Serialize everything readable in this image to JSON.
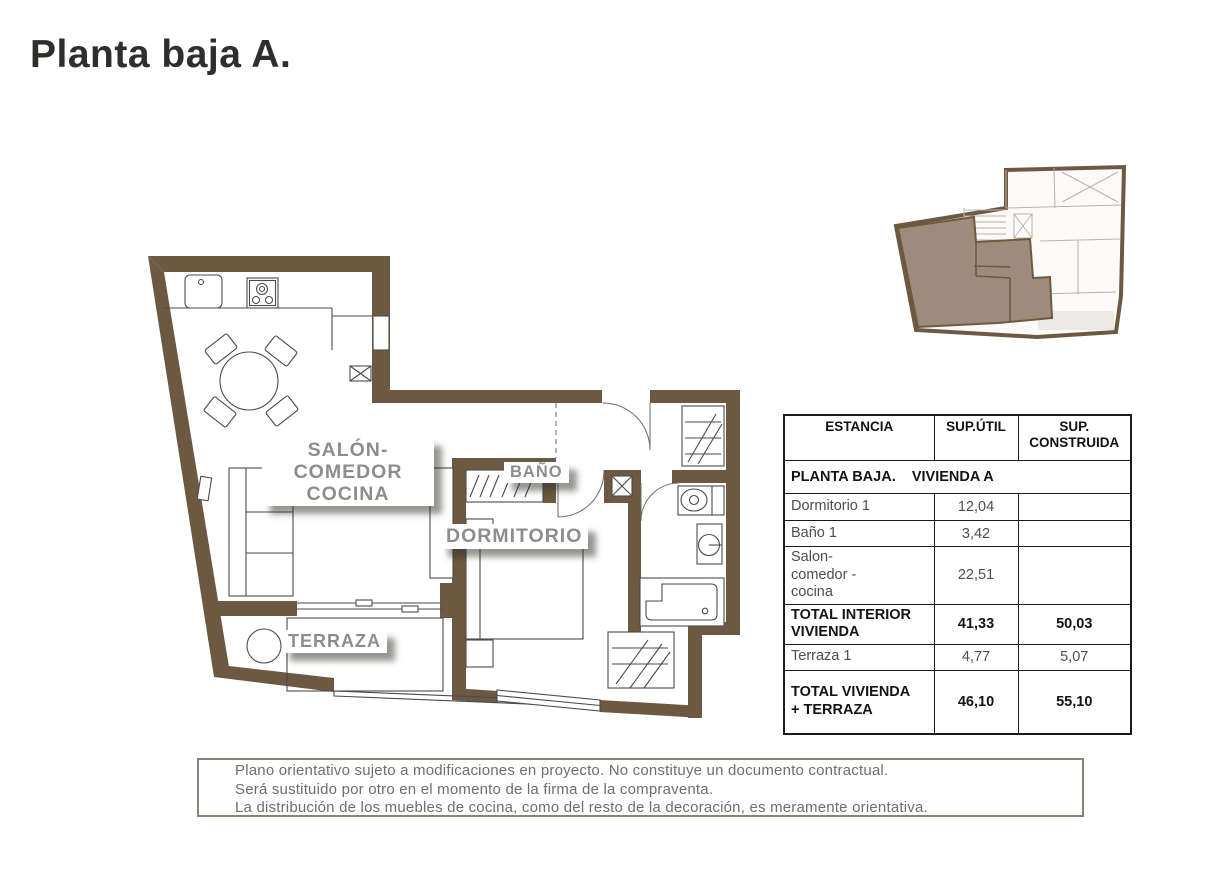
{
  "page": {
    "title": "Planta baja A."
  },
  "plan": {
    "labels": {
      "salon_line1": "SALÓN-COMEDOR",
      "salon_line2": "COCINA",
      "bano": "BAÑO",
      "dormitorio": "DORMITORIO",
      "terraza": "TERRAZA"
    }
  },
  "table": {
    "headers": {
      "estancia": "ESTANCIA",
      "sup_util": "SUP.ÚTIL",
      "sup_construida": "SUP.\nCONSTRUIDA"
    },
    "section_title": "PLANTA BAJA.    VIVIENDA A",
    "rows": [
      {
        "label": "Dormitorio 1",
        "sup_util": "12,04",
        "sup_construida": "",
        "bold": false
      },
      {
        "label": "Baño 1",
        "sup_util": "3,42",
        "sup_construida": "",
        "bold": false
      },
      {
        "label": "Salon-\ncomedor -\ncocina",
        "sup_util": "22,51",
        "sup_construida": "",
        "bold": false
      },
      {
        "label": "TOTAL INTERIOR\nVIVIENDA",
        "sup_util": "41,33",
        "sup_construida": "50,03",
        "bold": true
      },
      {
        "label": "Terraza 1",
        "sup_util": "4,77",
        "sup_construida": "5,07",
        "bold": false
      },
      {
        "label": "TOTAL VIVIENDA\n+ TERRAZA",
        "sup_util": "46,10",
        "sup_construida": "55,10",
        "bold": true
      }
    ]
  },
  "disclaimer": {
    "line1": "Plano orientativo sujeto a modificaciones en proyecto. No constituye un documento contractual.",
    "line2": "Será sustituido por otro en el momento de la firma de la compraventa.",
    "line3": "La distribución de los muebles de cocina, como del resto de la decoración, es meramente orientativa."
  },
  "colors": {
    "wall_brown": "#6d5942",
    "unit_highlight": "#9d8c7c",
    "label_gray": "#8d8d8d",
    "line_dark": "#4b4b4b",
    "hatch_brown": "#9b8467"
  }
}
